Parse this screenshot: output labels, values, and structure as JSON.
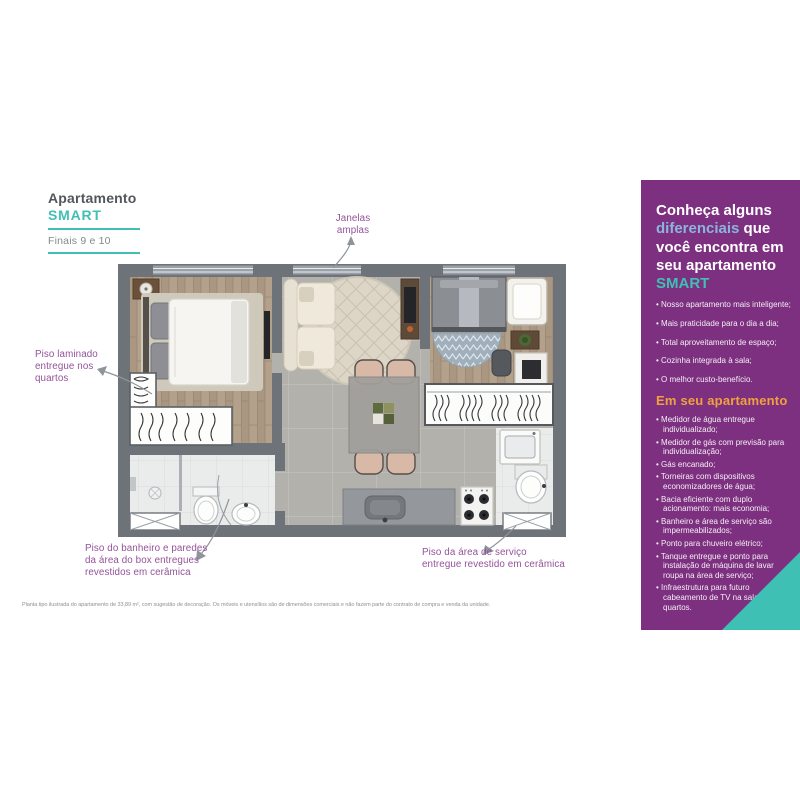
{
  "colors": {
    "purple_panel": "#7d3080",
    "teal": "#3fc0b4",
    "blue_accent": "#8ab5dc",
    "orange_accent": "#f0a13e",
    "annotation_purple": "#94519a",
    "header_gray": "#53575c",
    "arrow_gray": "#8f949a"
  },
  "header": {
    "line1": "Apartamento",
    "line2": "SMART",
    "subtitle": "Finais 9 e 10"
  },
  "plan": {
    "annotations": {
      "windows": "Janelas\namplas",
      "laminate": "Piso laminado\nentregue nos\nquartos",
      "bath": "Piso do banheiro e paredes\nda área do box entregues\nrevestidos em cerâmica",
      "service": "Piso da área de serviço\nentregue revestido em cerâmica"
    },
    "disclaimer": "Planta tipo ilustrada do apartamento de 33,89 m², com sugestão de decoração. Os móveis e utensílios são de dimensões comerciais e não fazem parte do contrato de compra e venda da unidade."
  },
  "panel": {
    "headline": {
      "part1": "Conheça alguns\n",
      "part2": "diferenciais",
      "part3": " que\nvocê encontra em\nseu apartamento\n",
      "part4": "SMART"
    },
    "bullets1": [
      "Nosso apartamento mais inteligente;",
      "Mais praticidade para o dia a dia;",
      "Total aproveitamento de espaço;",
      "Cozinha integrada à sala;",
      "O melhor custo-benefício."
    ],
    "subheading": "Em seu apartamento",
    "bullets2": [
      "Medidor de água entregue individualizado;",
      "Medidor de gás com previsão para individualização;",
      "Gás encanado;",
      "Torneiras com dispositivos economizadores de água;",
      "Bacia eficiente com duplo acionamento: mais economia;",
      "Banheiro e área de serviço são impermeabilizados;",
      "Ponto para chuveiro elétrico;",
      "Tanque entregue e ponto para instalação de máquina de lavar roupa na área de serviço;",
      "Infraestrutura para futuro cabeamento de TV na sala e nos quartos."
    ]
  }
}
